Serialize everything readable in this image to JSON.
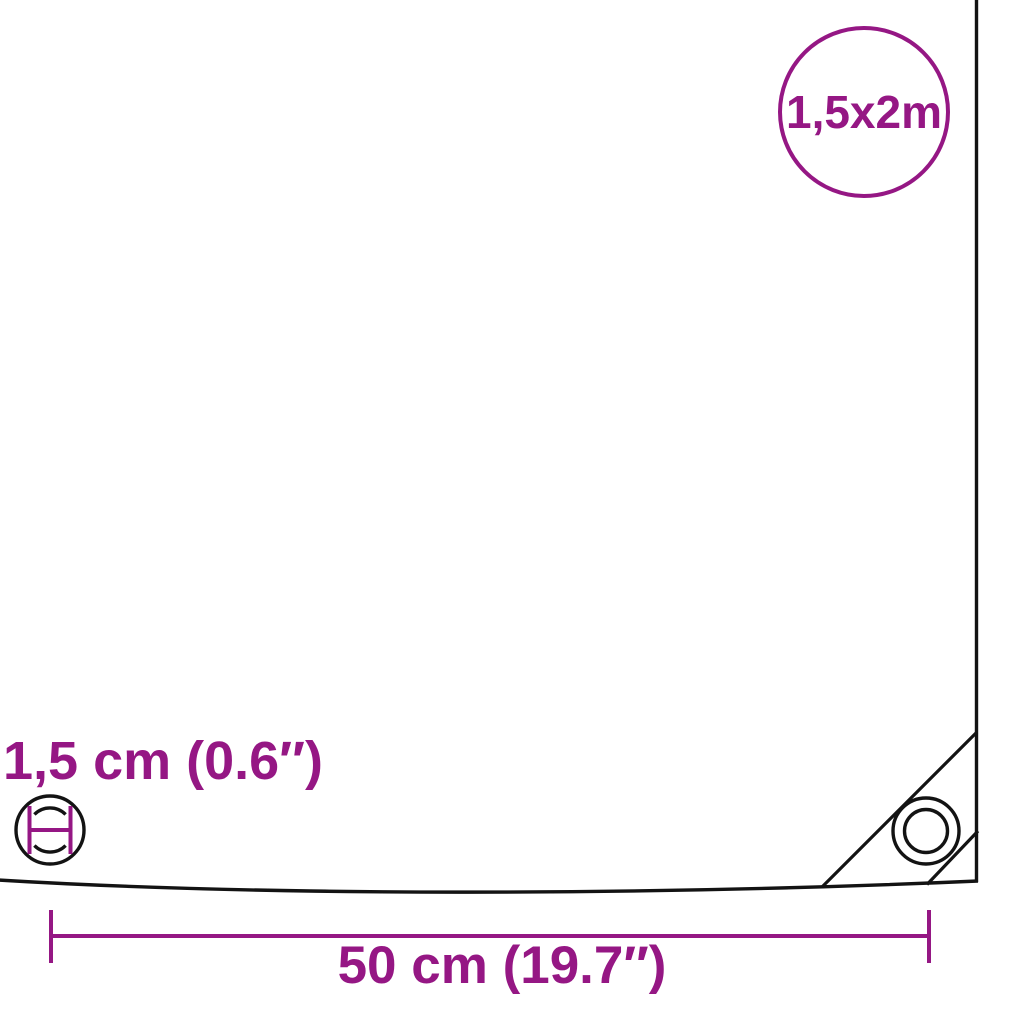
{
  "diagram": {
    "type": "product-dimension-diagram",
    "product": "tarpaulin sheet with corner reinforcement and eyelets"
  },
  "badge": {
    "size_label": "1,5x2m"
  },
  "labels": {
    "eyelet_diameter": "1,5 cm (0.6″)",
    "eyelet_spacing": "50 cm (19.7″)"
  },
  "icons": {
    "size_badge": "size-circle-badge",
    "eyelet_detail": "eyelet-diameter-icon",
    "corner_eyelet": "corner-eyelet-icon",
    "dimension_line": "spacing-dimension-line"
  },
  "colors": {
    "accent_purple": "#951784",
    "line_black": "#131313",
    "background": "#ffffff"
  }
}
